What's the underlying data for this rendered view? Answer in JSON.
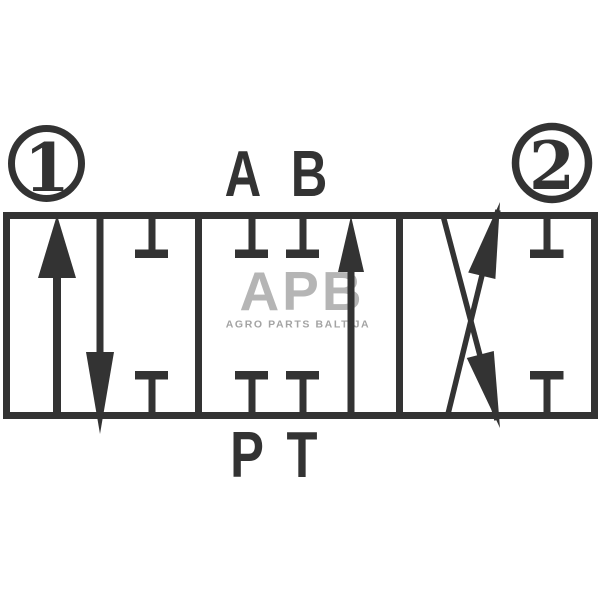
{
  "labels": {
    "position_1": "1",
    "position_2": "2",
    "port_a": "A",
    "port_b": "B",
    "port_p": "P",
    "port_t": "T"
  },
  "watermark": {
    "logo": "APB",
    "tagline": "AGRO PARTS BALTIJA"
  },
  "colors": {
    "line": "#333333",
    "watermark_logo": "#b5b5b5",
    "watermark_tagline": "#a3a3a3",
    "background": "#ffffff"
  }
}
